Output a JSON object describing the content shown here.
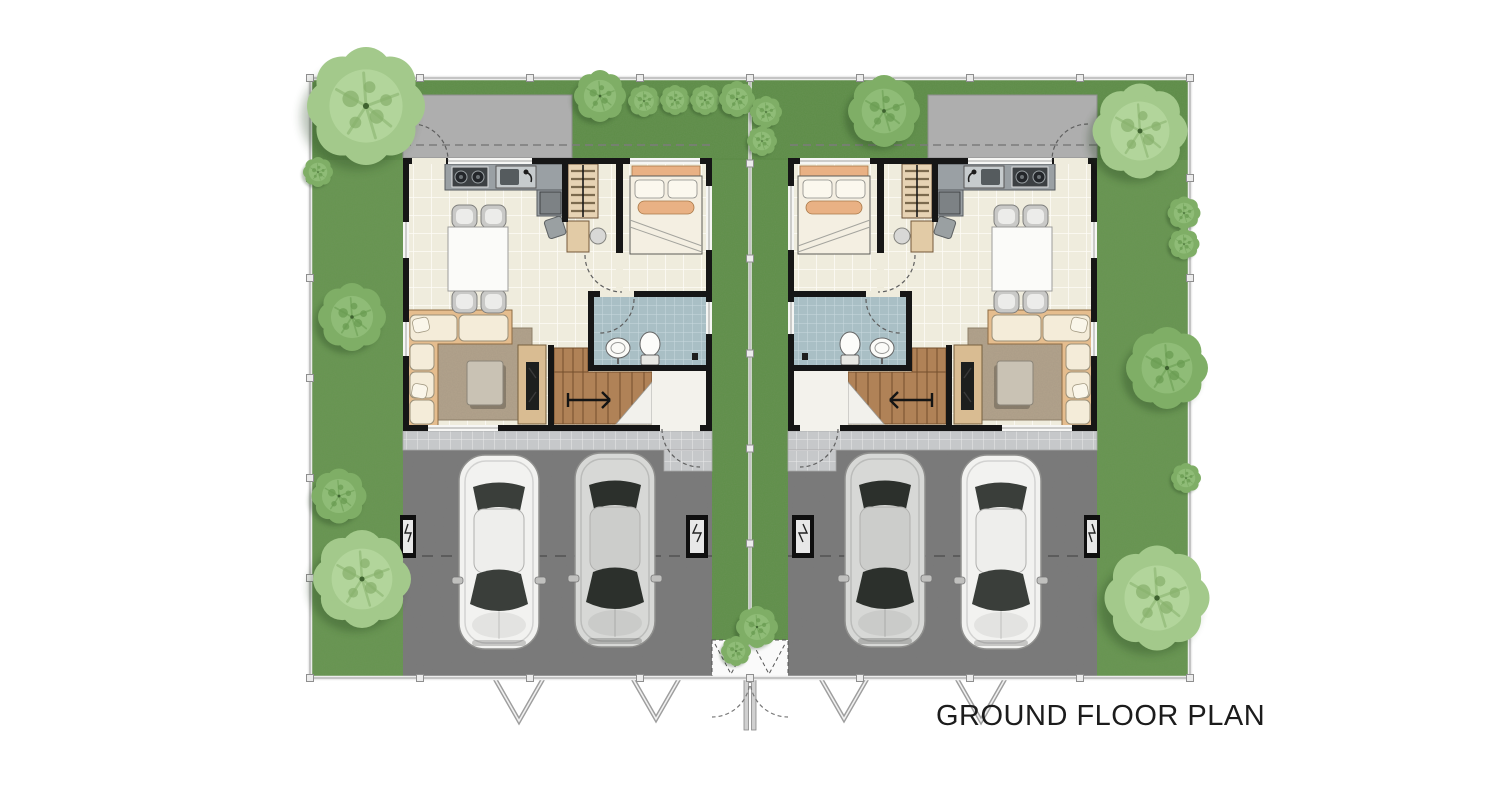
{
  "title": {
    "label": "GROUND FLOOR PLAN"
  },
  "plan": {
    "kind": "twin-house site plan, two mirrored units",
    "units": [
      {
        "id": "left-unit",
        "features": [
          "service-yard",
          "kitchen",
          "dining",
          "living",
          "bedroom",
          "bathroom",
          "wardrobe",
          "stairs",
          "entry",
          "terrace",
          "driveway"
        ],
        "cars": 2
      },
      {
        "id": "right-unit",
        "features": [
          "service-yard",
          "kitchen",
          "dining",
          "living",
          "bedroom",
          "bathroom",
          "wardrobe",
          "stairs",
          "entry",
          "terrace",
          "driveway"
        ],
        "cars": 2
      }
    ],
    "site": [
      "perimeter-fence",
      "center-fence",
      "trees",
      "hedges",
      "gates"
    ]
  },
  "colors": {
    "ink": "#1c1c1c",
    "grass": "#679550",
    "grass-dark": "#55863f",
    "tree-mid": "#7fae66",
    "tree-core": "#8fbc77",
    "tree-dark": "#689a50",
    "tree-light": "#a3c98b",
    "tree-light-core": "#b2d59b",
    "tree-light-dark": "#86b06b",
    "service": "#aeaeae",
    "drive": "#7b7b7b",
    "terrace": "#c6c8ca",
    "floor": "#efecdd",
    "floor-line": "#fdfcf6",
    "wall": "#161616",
    "bath": "#a9bfc5",
    "bath-line": "#c9dade",
    "stair": "#b08257",
    "stair-line": "#744f2c",
    "wood": "#d9bc92",
    "frame": "#e5bd8e",
    "cushion": "#f4ecd9",
    "rug": "#b3a38c",
    "counter": "#9aa0a4",
    "counter-dark": "#3c4043",
    "bed-accent": "#e9b184",
    "fence": "#ededed",
    "fence-dark": "#9b9b9b",
    "car-white": "#f2f2f0",
    "car-silver": "#d7d8d6",
    "car-glass": "#2f332f"
  }
}
